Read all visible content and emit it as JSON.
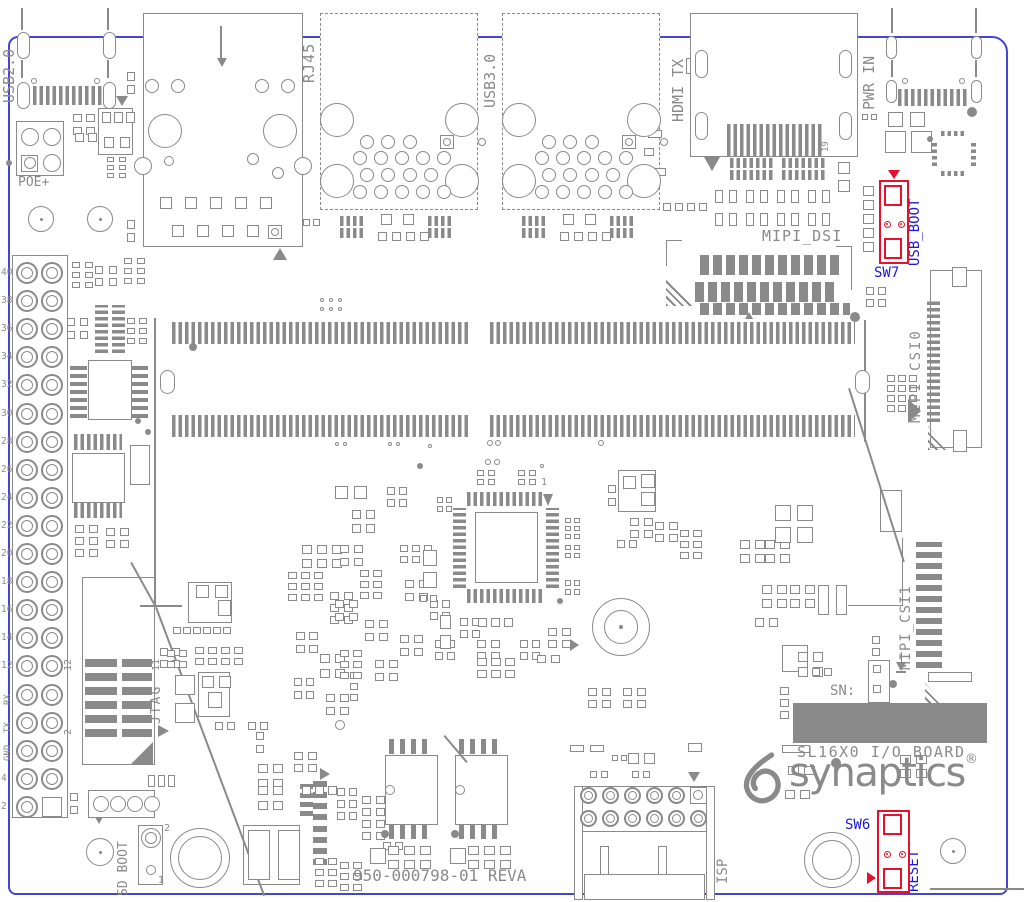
{
  "board": {
    "name": "SL16X0 I/O BOARD",
    "part_number": "950-000798-01 REVA",
    "brand": "synaptics",
    "registered_mark": "®",
    "serial_label": "SN:"
  },
  "connectors": {
    "usb2": "USB2.0",
    "poe": "POE+",
    "rj45": "RJ45",
    "usb3": "USB3.0",
    "hdmi_tx": "HDMI TX",
    "hdmi_pin19": "19",
    "pwr_in": "PWR IN",
    "mipi_dsi": "MIPI_DSI",
    "mipi_csi0": "MIPI CSI0",
    "mipi_csi1": "MIPI_CSI1",
    "isp": "ISP",
    "qfp_pin1": "1"
  },
  "jtag": {
    "label": "JTAG",
    "pin11": "11",
    "pin12": "12",
    "pin2": "2"
  },
  "sd_boot": {
    "label": "SD BOOT",
    "pin2": "2",
    "pin1": "1"
  },
  "switches": {
    "sw7": {
      "designator": "SW7",
      "function": "USB_BOOT"
    },
    "sw6": {
      "designator": "SW6",
      "function": "RESET"
    }
  },
  "gpio_header": {
    "pin_labels": [
      "40",
      "38",
      "36",
      "34",
      "32",
      "30",
      "28",
      "26",
      "24",
      "22",
      "20",
      "18",
      "16",
      "14",
      "12",
      "RX",
      "TX",
      "GND",
      "4",
      "2"
    ]
  },
  "colors": {
    "silkscreen_gray": "#8a8a8a",
    "board_outline_blue": "#4646cc",
    "switch_highlight_red": "#e8112d",
    "label_blue": "#1d18e0"
  }
}
